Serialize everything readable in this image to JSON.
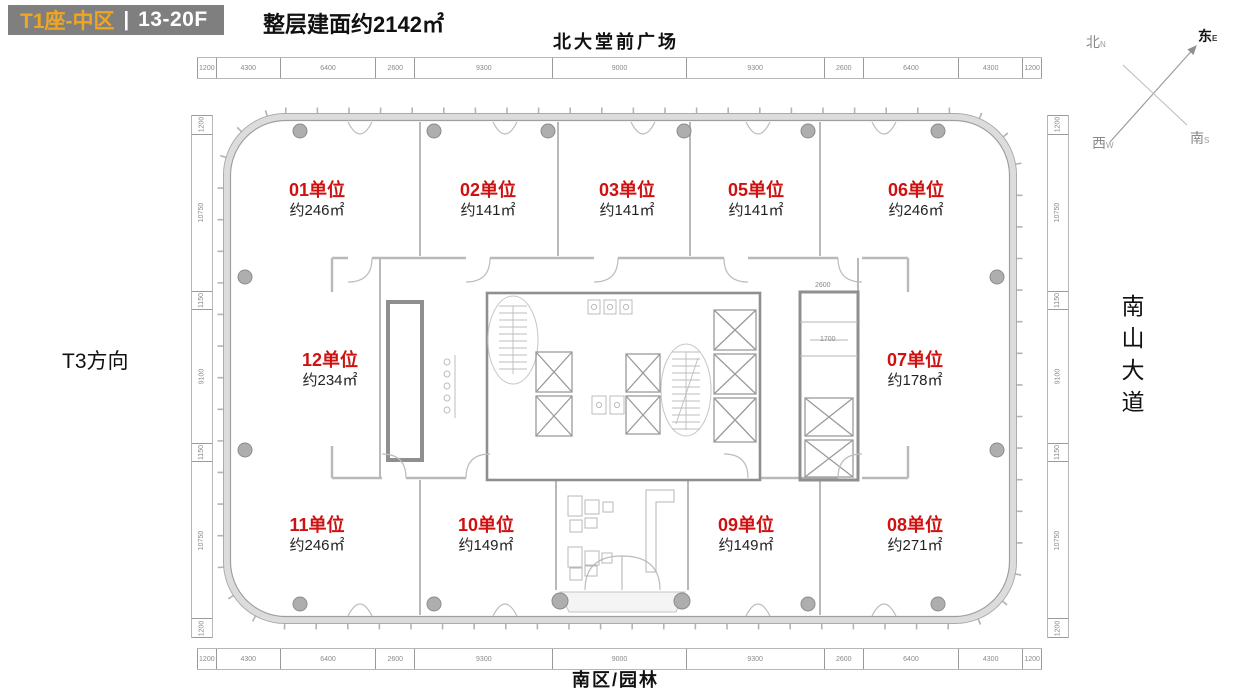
{
  "header": {
    "block_title": "T1座-中区",
    "divider": "|",
    "floor_range": "13-20F",
    "area_note": "整层建面约2142㎡"
  },
  "surroundings": {
    "top": "北大堂前广场",
    "bottom": "南区/园林",
    "left": "T3方向",
    "right": "南山大道"
  },
  "compass": {
    "north_cn": "北",
    "north_en": "N",
    "east_cn": "东",
    "east_en": "E",
    "south_cn": "南",
    "south_en": "S",
    "west_cn": "西",
    "west_en": "W"
  },
  "units": [
    {
      "id": "01",
      "label": "01单位",
      "area": "约246㎡",
      "pos": {
        "x": 317,
        "y": 200
      }
    },
    {
      "id": "02",
      "label": "02单位",
      "area": "约141㎡",
      "pos": {
        "x": 488,
        "y": 200
      }
    },
    {
      "id": "03",
      "label": "03单位",
      "area": "约141㎡",
      "pos": {
        "x": 627,
        "y": 200
      }
    },
    {
      "id": "05",
      "label": "05单位",
      "area": "约141㎡",
      "pos": {
        "x": 756,
        "y": 200
      }
    },
    {
      "id": "06",
      "label": "06单位",
      "area": "约246㎡",
      "pos": {
        "x": 916,
        "y": 200
      }
    },
    {
      "id": "12",
      "label": "12单位",
      "area": "约234㎡",
      "pos": {
        "x": 330,
        "y": 370
      }
    },
    {
      "id": "07",
      "label": "07单位",
      "area": "约178㎡",
      "pos": {
        "x": 915,
        "y": 370
      }
    },
    {
      "id": "11",
      "label": "11单位",
      "area": "约246㎡",
      "pos": {
        "x": 317,
        "y": 535
      }
    },
    {
      "id": "10",
      "label": "10单位",
      "area": "约149㎡",
      "pos": {
        "x": 486,
        "y": 535
      }
    },
    {
      "id": "09",
      "label": "09单位",
      "area": "约149㎡",
      "pos": {
        "x": 746,
        "y": 535
      }
    },
    {
      "id": "08",
      "label": "08单位",
      "area": "约271㎡",
      "pos": {
        "x": 915,
        "y": 535
      }
    }
  ],
  "dimensions": {
    "top": [
      "1200",
      "4300",
      "6400",
      "2600",
      "9300",
      "9000",
      "9300",
      "2600",
      "6400",
      "4300",
      "1200"
    ],
    "bottom": [
      "1200",
      "4300",
      "6400",
      "2600",
      "9300",
      "9000",
      "9300",
      "2600",
      "6400",
      "4300",
      "1200"
    ],
    "left": [
      "1200",
      "10750",
      "1150",
      "9100",
      "1150",
      "10750",
      "1200"
    ],
    "right": [
      "1200",
      "10750",
      "1150",
      "9100",
      "1150",
      "10750",
      "1200"
    ],
    "core_width": "2600",
    "core_inner": "1700"
  },
  "colors": {
    "accent_orange": "#F2A51E",
    "unit_red": "#CE1111",
    "header_gray": "#7F7F7F"
  }
}
